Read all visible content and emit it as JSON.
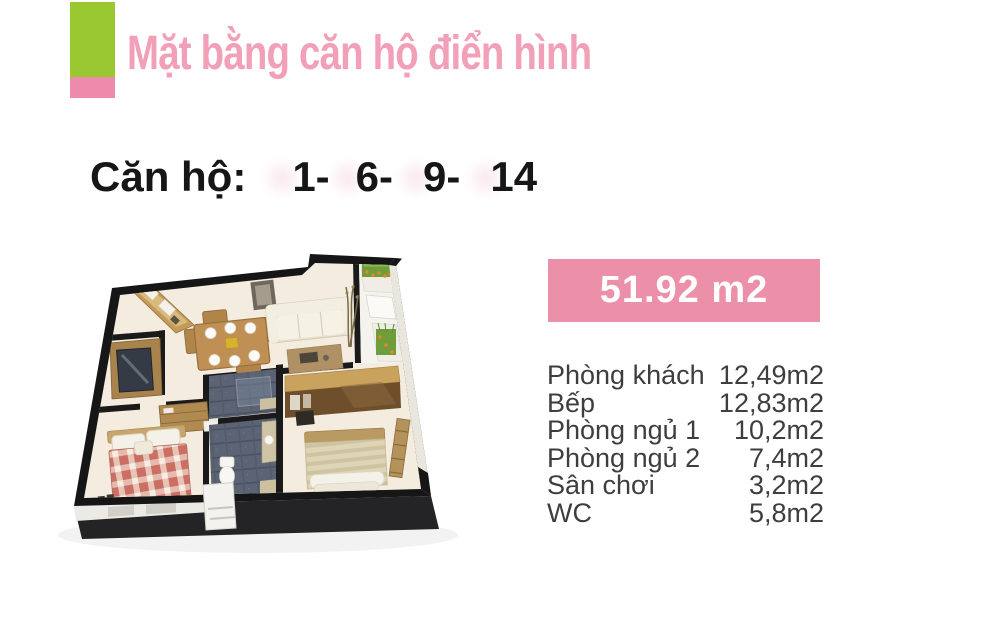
{
  "header": {
    "title": "Mặt bằng căn hộ điển hình"
  },
  "apartment_line": {
    "label": "Căn hộ:",
    "units": [
      "1-",
      "6-",
      "9-",
      "14"
    ]
  },
  "area_badge": {
    "value": "51.92 m2"
  },
  "room_list": {
    "rooms": [
      {
        "name": "Phòng khách",
        "area": "12,49m2"
      },
      {
        "name": "Bếp",
        "area": "12,83m2"
      },
      {
        "name": "Phòng ngủ 1",
        "area": "10,2m2"
      },
      {
        "name": "Phòng ngủ 2",
        "area": "7,4m2"
      },
      {
        "name": "Sân chơi",
        "area": "3,2m2"
      },
      {
        "name": "WC",
        "area": "5,8m2"
      }
    ]
  },
  "colors": {
    "accent_green": "#9ac831",
    "accent_pink": "#ee8bad",
    "title_pink": "#f2a0b8",
    "badge_pink": "#ec8fa9",
    "badge_text": "#ffffff",
    "body_text": "#3f3e3e"
  }
}
